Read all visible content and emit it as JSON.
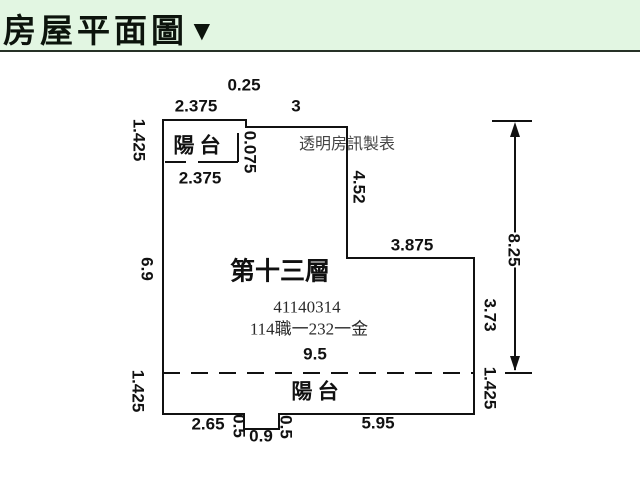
{
  "header": {
    "title": "房屋平面圖",
    "collapse_icon": "▼"
  },
  "colors": {
    "header_bg": "#e2f6e2",
    "header_border": "#263126",
    "header_text": "#0c140c",
    "line": "#111111",
    "watermark_text": "#454545",
    "secondary_text": "#2a2a2a"
  },
  "plan": {
    "labels": [
      {
        "name": "dim-top-step-width",
        "text": "0.25",
        "x": 244,
        "y": 85
      },
      {
        "name": "dim-balcony-top-width",
        "text": "2.375",
        "x": 196,
        "y": 106
      },
      {
        "name": "dim-top-wall-width",
        "text": "3",
        "x": 296,
        "y": 106
      },
      {
        "name": "balcony-top-label",
        "text": "陽 台",
        "x": 197,
        "y": 146,
        "cls": "cn"
      },
      {
        "name": "dim-step-height",
        "text": "0.075",
        "x": 250,
        "y": 152,
        "rot": true
      },
      {
        "name": "watermark-label",
        "text": "透明房訊製表",
        "x": 347,
        "y": 145,
        "cls": "wm"
      },
      {
        "name": "dim-balcony-bottom-width",
        "text": "2.375",
        "x": 200,
        "y": 178
      },
      {
        "name": "dim-upper-right-wall-height",
        "text": "4.52",
        "x": 359,
        "y": 187,
        "rot": true
      },
      {
        "name": "dim-left-balcony-height",
        "text": "1.425",
        "x": 139,
        "y": 140,
        "rot": true
      },
      {
        "name": "dim-left-wall-height",
        "text": "6.9",
        "x": 147,
        "y": 269,
        "rot": true
      },
      {
        "name": "dim-mid-wall-width",
        "text": "3.875",
        "x": 412,
        "y": 245
      },
      {
        "name": "floor-title",
        "text": "第十三層",
        "x": 280,
        "y": 272,
        "cls": "title"
      },
      {
        "name": "permit-number",
        "text": "41140314",
        "x": 307,
        "y": 307,
        "cls": "num"
      },
      {
        "name": "registration-number",
        "text": "114職一232一金",
        "x": 309,
        "y": 329,
        "cls": "num"
      },
      {
        "name": "dim-interior-width",
        "text": "9.5",
        "x": 315,
        "y": 354
      },
      {
        "name": "dim-lower-right-wall-height",
        "text": "3.73",
        "x": 490,
        "y": 315,
        "rot": true
      },
      {
        "name": "dim-overall-height",
        "text": "8.25",
        "x": 514,
        "y": 250,
        "rot": true,
        "bg": true
      },
      {
        "name": "dim-right-balcony-height",
        "text": "1.425",
        "x": 490,
        "y": 388,
        "rot": true
      },
      {
        "name": "dim-left-balcony2-height",
        "text": "1.425",
        "x": 138,
        "y": 391,
        "rot": true
      },
      {
        "name": "balcony-bottom-label",
        "text": "陽 台",
        "x": 315,
        "y": 392,
        "cls": "cn"
      },
      {
        "name": "dim-bottom-left-width",
        "text": "2.65",
        "x": 208,
        "y": 424
      },
      {
        "name": "dim-notch-left-depth",
        "text": "0.5",
        "x": 239,
        "y": 426,
        "rot": true
      },
      {
        "name": "dim-notch-width",
        "text": "0.9",
        "x": 261,
        "y": 436
      },
      {
        "name": "dim-notch-right-depth",
        "text": "0.5",
        "x": 286,
        "y": 427,
        "rot": true
      },
      {
        "name": "dim-bottom-right-width",
        "text": "5.95",
        "x": 378,
        "y": 423
      }
    ]
  }
}
